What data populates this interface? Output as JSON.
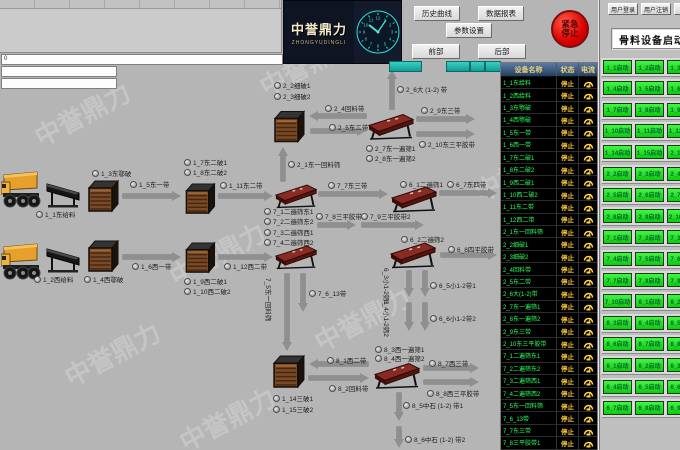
{
  "watermark": "中誉鼎力",
  "top_left_panel": {
    "value": "0"
  },
  "logo": {
    "title": "中誉鼎力",
    "subtitle": "ZHONGYUDINGLI"
  },
  "nav_buttons": [
    "历史曲线",
    "数据报表",
    "参数设置",
    "前部",
    "后部"
  ],
  "emergency_stop": "紧急停止",
  "user_buttons": [
    "用户登录",
    "用户注销"
  ],
  "right_panel": {
    "title": "骨料设备启动",
    "rows": [
      [
        "1_1启动",
        "1_2启动",
        "1_3启动"
      ],
      [
        "1_4启动",
        "1_5启动",
        "1_6启动"
      ],
      [
        "1_7启动",
        "1_8启动",
        "1_9启动"
      ],
      [
        "1_10启动",
        "1_11启动",
        "1_12启动"
      ],
      [
        "1_14启动",
        "1_15启动",
        "2_1启动"
      ],
      [
        "2_2启动",
        "2_3启动",
        "2_4启动"
      ],
      [
        "2_5启动",
        "2_6启动",
        "2_7启动"
      ],
      [
        "2_8启动",
        "2_9启动",
        "2_10启动"
      ],
      [
        "7_1启动",
        "7_2启动",
        "7_3启动"
      ],
      [
        "7_4启动",
        "7_5启动",
        "7_6启动"
      ],
      [
        "7_7启动",
        "7_8启动",
        "7_9启动"
      ],
      [
        "7_10启动",
        "8_1启动",
        "8_2启动"
      ],
      [
        "8_3启动",
        "8_4启动",
        "8_5启动"
      ],
      [
        "8_6启动",
        "8_7启动",
        "8_8启动"
      ],
      [
        "6_1启动",
        "6_2启动",
        "6_3启动"
      ],
      [
        "6_4启动",
        "6_5启动",
        "6_6启动"
      ],
      [
        "6_7启动",
        "6_8启动",
        "6_9启动"
      ]
    ]
  },
  "status_table": {
    "headers": [
      "设备名称",
      "状态",
      "电流"
    ],
    "status_value": "停止",
    "rows": [
      "1_1东给料",
      "1_2西给料",
      "1_3东鄂破",
      "1_4西鄂破",
      "1_5东一带",
      "1_6西一带",
      "1_7东二破1",
      "1_8东二破2",
      "1_9西二破1",
      "1_10西二破2",
      "1_11东二带",
      "1_12西二带",
      "2_1东一回料筛",
      "2_2细破1",
      "2_3细破2",
      "2_4回料带",
      "2_5东二带",
      "2_6大(1-2)带",
      "2_7东一遍筛1",
      "2_8东一遍筛2",
      "2_9东三带",
      "2_10东三平胶带",
      "7_1二遍筛东1",
      "7_2二遍筛东2",
      "7_3二遍筛西1",
      "7_4二遍筛西2",
      "7_5东一回料筛",
      "7_6_13带",
      "7_7东三带",
      "7_8三平胶带1"
    ]
  },
  "flow": {
    "machines": [
      {
        "type": "truck",
        "x": 1,
        "y": 170,
        "w": 44,
        "h": 40
      },
      {
        "type": "truck",
        "x": 1,
        "y": 242,
        "w": 44,
        "h": 40
      },
      {
        "type": "feeder",
        "x": 46,
        "y": 181,
        "w": 36,
        "h": 27
      },
      {
        "type": "feeder",
        "x": 46,
        "y": 246,
        "w": 36,
        "h": 27
      },
      {
        "type": "crusher",
        "x": 86,
        "y": 179,
        "w": 34,
        "h": 34
      },
      {
        "type": "crusher",
        "x": 86,
        "y": 239,
        "w": 34,
        "h": 34
      },
      {
        "type": "crusher",
        "x": 183,
        "y": 182,
        "w": 34,
        "h": 33
      },
      {
        "type": "crusher",
        "x": 183,
        "y": 241,
        "w": 34,
        "h": 33
      },
      {
        "type": "crusher",
        "x": 272,
        "y": 109,
        "w": 34,
        "h": 35
      },
      {
        "type": "crusher",
        "x": 271,
        "y": 354,
        "w": 35,
        "h": 35
      },
      {
        "type": "screen",
        "x": 274,
        "y": 182,
        "w": 44,
        "h": 28
      },
      {
        "type": "screen",
        "x": 274,
        "y": 243,
        "w": 44,
        "h": 28
      },
      {
        "type": "screen",
        "x": 367,
        "y": 111,
        "w": 48,
        "h": 31
      },
      {
        "type": "screen",
        "x": 390,
        "y": 185,
        "w": 48,
        "h": 28
      },
      {
        "type": "screen",
        "x": 389,
        "y": 241,
        "w": 48,
        "h": 28
      },
      {
        "type": "screen",
        "x": 373,
        "y": 360,
        "w": 48,
        "h": 31
      }
    ],
    "labels": [
      {
        "t": "1_3东鄂破",
        "x": 92,
        "y": 168
      },
      {
        "t": "1_1东给料",
        "x": 36,
        "y": 209
      },
      {
        "t": "1_5东一带",
        "x": 130,
        "y": 179
      },
      {
        "t": "1_2西给料",
        "x": 34,
        "y": 274
      },
      {
        "t": "1_4西鄂破",
        "x": 84,
        "y": 274
      },
      {
        "t": "1_6西一带",
        "x": 132,
        "y": 261
      },
      {
        "t": "1_7东二破1",
        "x": 184,
        "y": 157
      },
      {
        "t": "1_8东二破2",
        "x": 184,
        "y": 167
      },
      {
        "t": "1_11东二带",
        "x": 220,
        "y": 180
      },
      {
        "t": "1_9西二破1",
        "x": 184,
        "y": 276
      },
      {
        "t": "1_10西二破2",
        "x": 184,
        "y": 286
      },
      {
        "t": "1_12西二带",
        "x": 224,
        "y": 261
      },
      {
        "t": "2_2细破1",
        "x": 274,
        "y": 80
      },
      {
        "t": "2_3细破2",
        "x": 274,
        "y": 91
      },
      {
        "t": "2_1东一回料筛",
        "x": 288,
        "y": 159
      },
      {
        "t": "2_4回料带",
        "x": 325,
        "y": 103
      },
      {
        "t": "2_5东二带",
        "x": 329,
        "y": 122
      },
      {
        "t": "2_6大 (1-2) 带",
        "x": 397,
        "y": 84
      },
      {
        "t": "2_7东一遍筛1",
        "x": 366,
        "y": 143
      },
      {
        "t": "2_8东一遍筛2",
        "x": 366,
        "y": 153
      },
      {
        "t": "2_9东三带",
        "x": 421,
        "y": 105
      },
      {
        "t": "2_10东三平胶带",
        "x": 419,
        "y": 139
      },
      {
        "t": "7_1二遍筛东1",
        "x": 264,
        "y": 206
      },
      {
        "t": "7_2二遍筛东2",
        "x": 264,
        "y": 216
      },
      {
        "t": "7_3二遍筛西1",
        "x": 264,
        "y": 227
      },
      {
        "t": "7_4二遍筛西2",
        "x": 264,
        "y": 237
      },
      {
        "t": "7_7东三带",
        "x": 328,
        "y": 180
      },
      {
        "t": "7_8三平胶带1",
        "x": 316,
        "y": 211
      },
      {
        "t": "7_9三平胶带2",
        "x": 361,
        "y": 211
      },
      {
        "t": "6_1二遍筛1",
        "x": 400,
        "y": 179
      },
      {
        "t": "6_7东四带",
        "x": 447,
        "y": 179
      },
      {
        "t": "6_2二遍筛2",
        "x": 401,
        "y": 234
      },
      {
        "t": "6_8四平胶带",
        "x": 448,
        "y": 244
      },
      {
        "t": "6_3小1-2筛1",
        "x": 392,
        "y": 268,
        "rot": true
      },
      {
        "t": "6_5小1-2带1",
        "x": 430,
        "y": 280
      },
      {
        "t": "6_4小1-2筛2",
        "x": 392,
        "y": 300,
        "rot": true
      },
      {
        "t": "6_6小1-2带2",
        "x": 430,
        "y": 313
      },
      {
        "t": "7_5东一回料筛",
        "x": 274,
        "y": 278,
        "rot": true
      },
      {
        "t": "7_6_13带",
        "x": 309,
        "y": 288
      },
      {
        "t": "1_14三破1",
        "x": 273,
        "y": 393
      },
      {
        "t": "1_15三破2",
        "x": 273,
        "y": 404
      },
      {
        "t": "8_1西二带",
        "x": 327,
        "y": 355
      },
      {
        "t": "8_2回料带",
        "x": 329,
        "y": 383
      },
      {
        "t": "8_3西一遍筛1",
        "x": 375,
        "y": 344
      },
      {
        "t": "8_4西一遍筛2",
        "x": 375,
        "y": 353
      },
      {
        "t": "8_7西三带",
        "x": 429,
        "y": 358
      },
      {
        "t": "8_8西三平胶带",
        "x": 427,
        "y": 388
      },
      {
        "t": "8_5中石 (1-2) 带1",
        "x": 403,
        "y": 400
      },
      {
        "t": "8_6中石 (1-2) 带2",
        "x": 405,
        "y": 434
      }
    ],
    "arrows": [
      {
        "x1": 123,
        "y1": 196,
        "x2": 181,
        "y2": 196
      },
      {
        "x1": 123,
        "y1": 257,
        "x2": 181,
        "y2": 257
      },
      {
        "x1": 219,
        "y1": 196,
        "x2": 273,
        "y2": 196
      },
      {
        "x1": 219,
        "y1": 257,
        "x2": 273,
        "y2": 257
      },
      {
        "x1": 283,
        "y1": 181,
        "x2": 283,
        "y2": 147
      },
      {
        "x1": 366,
        "y1": 116,
        "x2": 309,
        "y2": 116
      },
      {
        "x1": 311,
        "y1": 131,
        "x2": 366,
        "y2": 131
      },
      {
        "x1": 392,
        "y1": 109,
        "x2": 392,
        "y2": 70
      },
      {
        "x1": 417,
        "y1": 119,
        "x2": 475,
        "y2": 119
      },
      {
        "x1": 417,
        "y1": 134,
        "x2": 475,
        "y2": 134
      },
      {
        "x1": 319,
        "y1": 194,
        "x2": 388,
        "y2": 194
      },
      {
        "x1": 318,
        "y1": 225,
        "x2": 356,
        "y2": 225
      },
      {
        "x1": 362,
        "y1": 225,
        "x2": 424,
        "y2": 225
      },
      {
        "x1": 440,
        "y1": 193,
        "x2": 497,
        "y2": 193
      },
      {
        "x1": 441,
        "y1": 255,
        "x2": 497,
        "y2": 255
      },
      {
        "x1": 409,
        "y1": 271,
        "x2": 409,
        "y2": 297
      },
      {
        "x1": 425,
        "y1": 271,
        "x2": 425,
        "y2": 297
      },
      {
        "x1": 409,
        "y1": 303,
        "x2": 409,
        "y2": 331
      },
      {
        "x1": 425,
        "y1": 303,
        "x2": 425,
        "y2": 331
      },
      {
        "x1": 287,
        "y1": 274,
        "x2": 287,
        "y2": 351
      },
      {
        "x1": 303,
        "y1": 274,
        "x2": 303,
        "y2": 312
      },
      {
        "x1": 368,
        "y1": 364,
        "x2": 309,
        "y2": 364
      },
      {
        "x1": 309,
        "y1": 378,
        "x2": 369,
        "y2": 378
      },
      {
        "x1": 424,
        "y1": 368,
        "x2": 479,
        "y2": 368
      },
      {
        "x1": 424,
        "y1": 382,
        "x2": 479,
        "y2": 382
      },
      {
        "x1": 399,
        "y1": 393,
        "x2": 399,
        "y2": 421
      },
      {
        "x1": 399,
        "y1": 427,
        "x2": 399,
        "y2": 448
      }
    ]
  }
}
